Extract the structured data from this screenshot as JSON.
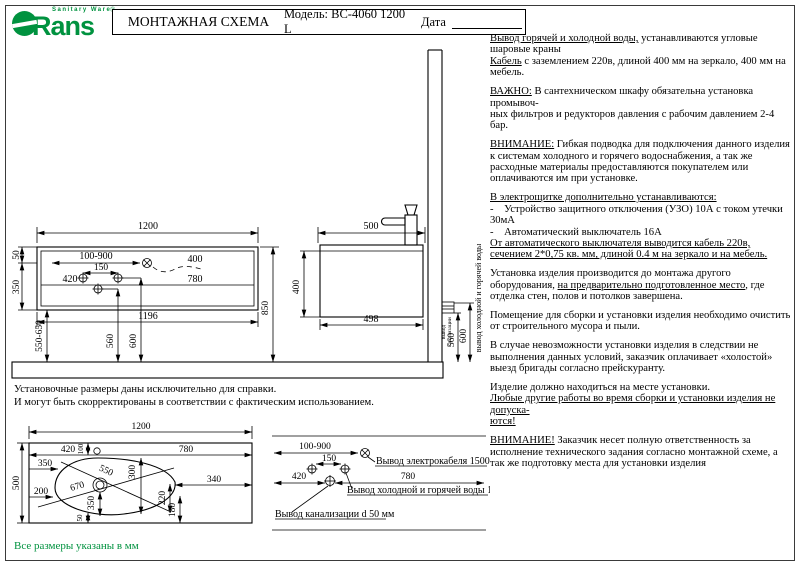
{
  "meta": {
    "brand_green": "#00923F",
    "ink": "#000000"
  },
  "header": {
    "logo": {
      "brand": "Rans",
      "tagline": "Sanitary Ware",
      "reg": "®"
    },
    "title": "МОНТАЖНАЯ СХЕМА",
    "model": "Модель: BC-4060 1200 L",
    "date_label": "Дата"
  },
  "instructions": [
    [
      {
        "t": "Вывод горячей и холодной воды,",
        "u": true
      },
      {
        "t": " устанавливаются угловые шаровые краны"
      },
      {
        "br": true
      },
      {
        "t": "Кабель",
        "u": true
      },
      {
        "t": " с заземлением 220в, длиной 400 мм на зеркало, 400 мм на мебель."
      }
    ],
    [
      {
        "t": "ВАЖНО:",
        "u": true
      },
      {
        "t": " В сантехническом шкафу обязательна установка промывоч-"
      },
      {
        "br": true
      },
      {
        "t": "ных фильтров и редукторов давления с рабочим давлением 2-4 бар."
      }
    ],
    [
      {
        "t": "ВНИМАНИЕ:",
        "u": true
      },
      {
        "t": " Гибкая подводка для подключения данного изделия к системам холодного и горячего водоснабжения, а так же расходные материалы предоставляются покупателем или оплачиваются им при установке."
      }
    ],
    [
      {
        "t": "В электрощитке дополнительно устанавливаются:",
        "u": true
      },
      {
        "br": true
      },
      {
        "t": "-    Устройство защитного отключения (УЗО) 10А с током утечки 30мА"
      },
      {
        "br": true
      },
      {
        "t": "-    Автоматический выключатель 16А"
      },
      {
        "br": true
      },
      {
        "t": "От автоматического выключателя выводится кабель 220в, сечением 2*0,75 кв. мм, длиной 0.4 м на зеркало и на мебель.",
        "u": true
      }
    ],
    [
      {
        "t": "Установка изделия производится до монтажа другого оборудования, "
      },
      {
        "t": "на предварительно подготовленное место",
        "u": true
      },
      {
        "t": ", где отделка стен, полов и потолков завершена."
      }
    ],
    [
      {
        "t": "Помещение для сборки и установки изделия необходимо очистить от строительного мусора и пыли."
      }
    ],
    [
      {
        "t": "В случае невозможности установки изделия в следствии не выполнения данных условий, заказчик оплачивает «холостой» выезд бригады согласно прейскуранту."
      }
    ],
    [
      {
        "t": "Изделие должно находиться на месте установки."
      },
      {
        "br": true
      },
      {
        "t": "Любые другие работы во время сборки и установки изделия не допуска-",
        "u": true
      },
      {
        "br": true
      },
      {
        "t": "ются!",
        "u": true
      }
    ],
    [
      {
        "t": "ВНИМАНИЕ!",
        "u": true
      },
      {
        "t": " Заказчик несет полную ответственность за исполнение технического задания согласно монтажной схеме, а так же подготовку места для установки изделия"
      }
    ]
  ],
  "front_view": {
    "dims": {
      "width": "1200",
      "t50": "50",
      "t350": "350",
      "range": "100-900",
      "cable": "400",
      "between": "150",
      "left": "420",
      "right": "780",
      "inner_width": "1196",
      "mount": "550-650",
      "sewer_h": "560",
      "water_h": "600",
      "total_h": "850"
    }
  },
  "side_view": {
    "dims": {
      "depth": "500",
      "height": "400",
      "bottom_depth": "498",
      "sewer_h": "560",
      "water_h": "600"
    },
    "labels": {
      "water": "вывод холодной и горячей воды",
      "sewer_1": "вывод",
      "sewer_2": "канализации"
    }
  },
  "top_view": {
    "dims": {
      "width": "1200",
      "depth": "500",
      "left": "420",
      "right": "780",
      "t100": "100",
      "d350": "350",
      "d550": "550",
      "d300": "300",
      "d670": "670",
      "d200": "200",
      "v350": "350",
      "d50": "50",
      "d220": "220",
      "d180": "180",
      "d340": "340"
    }
  },
  "outlets_view": {
    "dims": {
      "range": "100-900",
      "between": "150",
      "left": "420",
      "right": "780"
    },
    "labels": {
      "cable": "Вывод электрокабеля 1500 мм",
      "water": "Вывод холодной и горячей воды 1/2\"",
      "sewer": "Вывод канализации d 50 мм"
    }
  },
  "notes": {
    "line1": "Установочные размеры даны исключительно для справки.",
    "line2": "И могут быть скорректированы в соответствии с фактическим использованием.",
    "footer": "Все размеры указаны в мм"
  }
}
